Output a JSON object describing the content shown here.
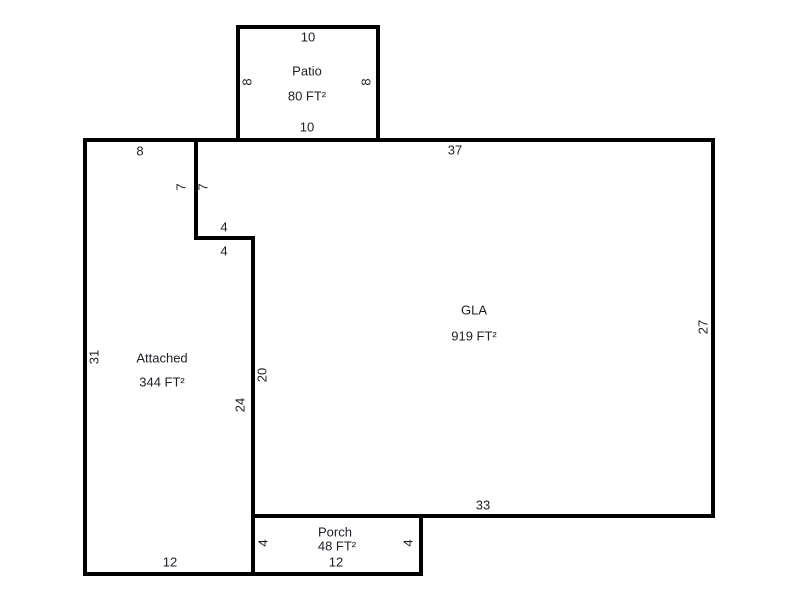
{
  "colors": {
    "background": "#ffffff",
    "wall": "#000000",
    "text": "#1e1e28"
  },
  "floorplan": {
    "rooms": [
      {
        "id": "patio",
        "name": "Patio",
        "area": "80 FT²"
      },
      {
        "id": "gla",
        "name": "GLA",
        "area": "919 FT²"
      },
      {
        "id": "attached",
        "name": "Attached",
        "area": "344 FT²"
      },
      {
        "id": "porch",
        "name": "Porch",
        "area": "48 FT²"
      }
    ],
    "labels": [
      {
        "name": "dim-patio-top",
        "text": "10",
        "x": 308,
        "y": 37
      },
      {
        "name": "room-name-patio",
        "room": "patio",
        "field": "name",
        "x": 307,
        "y": 71
      },
      {
        "name": "room-area-patio",
        "room": "patio",
        "field": "area",
        "x": 307,
        "y": 96
      },
      {
        "name": "dim-patio-left",
        "text": "8",
        "x": 247,
        "y": 82,
        "rot": 1
      },
      {
        "name": "dim-patio-right",
        "text": "8",
        "x": 366,
        "y": 82,
        "rot": 1
      },
      {
        "name": "dim-patio-bottom",
        "text": "10",
        "x": 307,
        "y": 127
      },
      {
        "name": "dim-attached-top",
        "text": "8",
        "x": 140,
        "y": 151
      },
      {
        "name": "dim-gla-top",
        "text": "37",
        "x": 455,
        "y": 150
      },
      {
        "name": "dim-notch-vert-attached",
        "text": "7",
        "x": 181,
        "y": 187,
        "rot": 1
      },
      {
        "name": "dim-notch-vert-gla",
        "text": "7",
        "x": 203,
        "y": 187,
        "rot": 1
      },
      {
        "name": "dim-notch-horiz-attached",
        "text": "4",
        "x": 224,
        "y": 227
      },
      {
        "name": "dim-notch-horiz-gla",
        "text": "4",
        "x": 224,
        "y": 251
      },
      {
        "name": "room-name-gla",
        "room": "gla",
        "field": "name",
        "x": 474,
        "y": 310
      },
      {
        "name": "room-area-gla",
        "room": "gla",
        "field": "area",
        "x": 474,
        "y": 336
      },
      {
        "name": "dim-gla-right",
        "text": "27",
        "x": 703,
        "y": 327,
        "rot": 1
      },
      {
        "name": "dim-attached-left",
        "text": "31",
        "x": 94,
        "y": 357,
        "rot": 1
      },
      {
        "name": "room-name-attached",
        "room": "attached",
        "field": "name",
        "x": 162,
        "y": 358
      },
      {
        "name": "room-area-attached",
        "room": "attached",
        "field": "area",
        "x": 162,
        "y": 382
      },
      {
        "name": "dim-gla-left",
        "text": "20",
        "x": 262,
        "y": 375,
        "rot": 1
      },
      {
        "name": "dim-attached-right",
        "text": "24",
        "x": 240,
        "y": 405,
        "rot": 1
      },
      {
        "name": "dim-gla-bottom",
        "text": "33",
        "x": 483,
        "y": 505
      },
      {
        "name": "room-name-porch",
        "room": "porch",
        "field": "name",
        "x": 335,
        "y": 532
      },
      {
        "name": "room-area-porch",
        "room": "porch",
        "field": "area",
        "x": 337,
        "y": 546
      },
      {
        "name": "dim-porch-left",
        "text": "4",
        "x": 263,
        "y": 543,
        "rot": 1
      },
      {
        "name": "dim-porch-right",
        "text": "4",
        "x": 408,
        "y": 543,
        "rot": 1
      },
      {
        "name": "dim-porch-bottom",
        "text": "12",
        "x": 336,
        "y": 562
      },
      {
        "name": "dim-attached-bottom",
        "text": "12",
        "x": 170,
        "y": 562
      }
    ]
  }
}
